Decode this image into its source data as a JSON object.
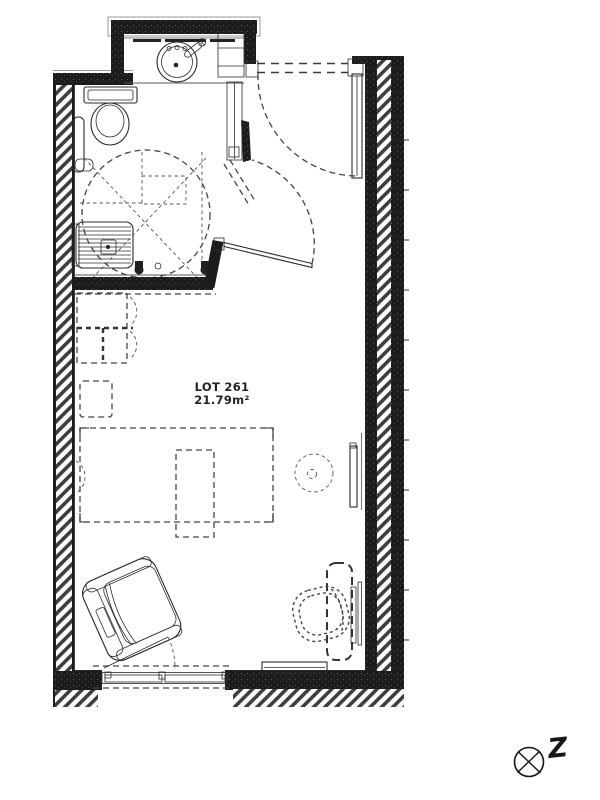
{
  "drawing": {
    "lot_label": "LOT 261",
    "area_label": "21.79m²",
    "north_label": "Z"
  },
  "colors": {
    "background": "#ffffff",
    "ink": "#2b2b2e",
    "wall_fill": "#1c1c1f",
    "hatch_stripe": "#3d3d42",
    "dashed_line": "#44444a"
  },
  "fixtures": [
    "washbasin",
    "vanity-counter",
    "vanity-shelves",
    "toilet",
    "grab-bar",
    "shower-seat",
    "wheelchair-turning-circle",
    "bathroom-door",
    "entrance-door",
    "duct",
    "wardrobe",
    "storage-square",
    "bed",
    "overbed-table",
    "side-table",
    "wall-panel",
    "armchair",
    "desk",
    "desk-chair",
    "radiator",
    "french-window",
    "north-compass"
  ]
}
